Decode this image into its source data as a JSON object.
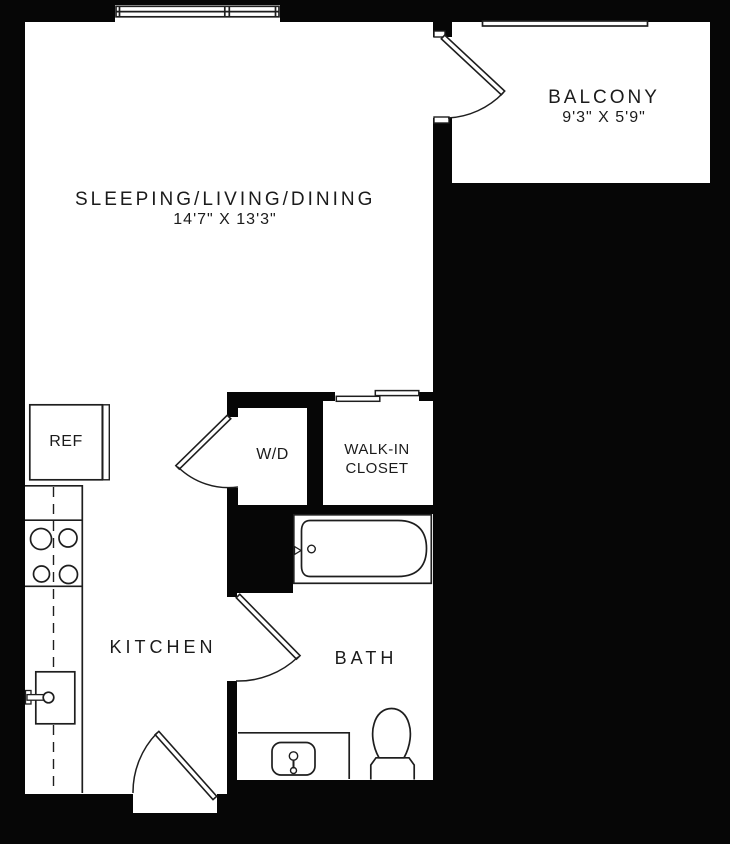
{
  "rooms": {
    "main": {
      "name": "SLEEPING/LIVING/DINING",
      "dims": "14'7\" X 13'3\""
    },
    "balcony": {
      "name": "BALCONY",
      "dims": "9'3\" X 5'9\""
    },
    "kitchen": {
      "name": "KITCHEN"
    },
    "bath": {
      "name": "BATH"
    },
    "walk_in_closet": {
      "line1": "WALK-IN",
      "line2": "CLOSET"
    },
    "laundry": {
      "name": "W/D"
    },
    "fridge": {
      "name": "REF"
    }
  },
  "fixtures": [
    "refrigerator",
    "range-burners",
    "kitchen-sink",
    "washer-dryer",
    "bathtub",
    "vanity-sink",
    "toilet",
    "balcony-railing",
    "window"
  ],
  "colors": {
    "wall": "#060606",
    "floor": "#ffffff",
    "line": "#1e1e1e",
    "text": "#1b1b1b"
  }
}
